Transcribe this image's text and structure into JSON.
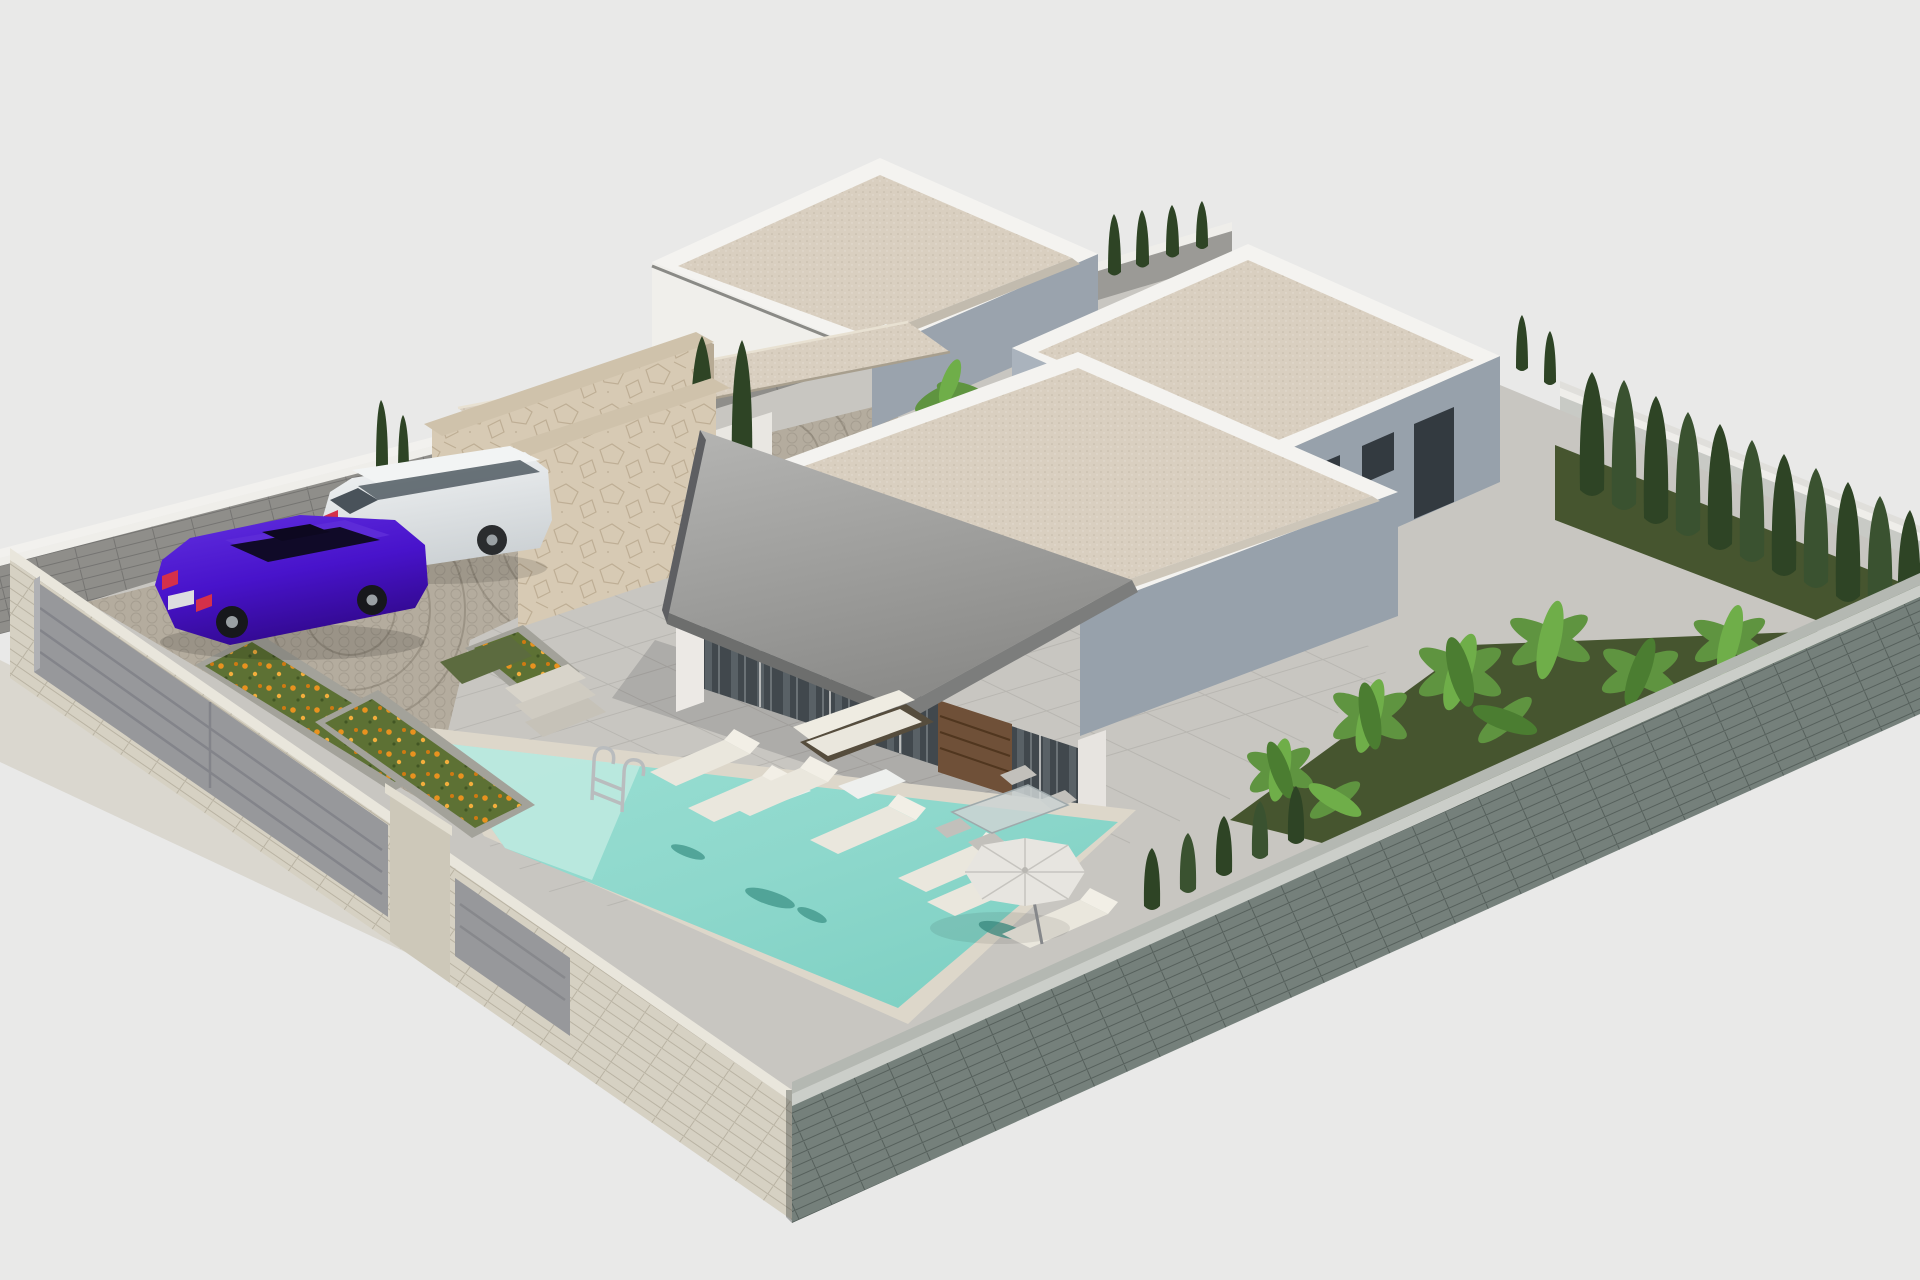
{
  "scene": {
    "title": "3D architectural rendering of a modern single-storey villa with pool",
    "style": "isometric exterior render on flat light-grey background",
    "background": "#e9e9e8",
    "colors": {
      "background": "#e9e9e8",
      "parapet_white": "#f4f3f0",
      "facade_white": "#f0efeb",
      "facade_shadow": "#97a1ab",
      "facade_shadow_light": "#aab3bd",
      "roof_gravel": "#d9cfc0",
      "awning_fascia": "#6d6e6d",
      "glass_dark": "#41484d",
      "wood_door": "#6f5038",
      "stone_clad": "#d7cab4",
      "stone_cap": "#cfc2ab",
      "wall_cap": "#efeeea",
      "wall_inner_nw": "#8f8e8a",
      "wall_inner_ne": "#c8cac5",
      "wall_outer_se": "#75807b",
      "wall_outer_sw": "#d6d1c3",
      "gate_grey": "#97989b",
      "pillar_beige": "#cdc8b9",
      "sidewalk": "#dad7cf",
      "terrace_paving": "#c8c6c1",
      "driveway_cobble": "#b4ac9e",
      "porch_shade": "rgba(35,38,42,0.16)",
      "pool_water": "#8ed8cc",
      "pool_shallow": "#bfeae1",
      "pool_coping": "#ddd7ca",
      "grass_dark": "#46552f",
      "grass_light": "#5c6b3f",
      "cypress_dark": "#2e4425",
      "banana_green": "#5f9440",
      "flower_green": "#5d7134",
      "flower_orange": "#e8921f",
      "car_purple": "#4813cb",
      "car_purple_roof": "#5d2bd8",
      "car_window_dark": "#100a28",
      "car_white": "#e9ecee",
      "suv_window": "#5c666d",
      "cushion_white": "#eae7dd",
      "wicker_dark": "#564d3d",
      "umbrella_white": "#e7e5e0",
      "chrome": "#b9bcbe",
      "taillight_red": "#d5304a"
    },
    "objects": [
      {
        "name": "main-villa",
        "desc": "white flat-roof villa with grey sloped awning, glass facade, wood slat door and covered terrace"
      },
      {
        "name": "back-house",
        "desc": "white flat-roof house at the rear with beige gravel roof"
      },
      {
        "name": "right-house",
        "desc": "white flat-roof house on the right with dark window openings on shaded facade"
      },
      {
        "name": "stone-privacy-walls",
        "desc": "beige natural-stone clad walls at the entrance courtyard"
      },
      {
        "name": "swimming-pool",
        "desc": "turquoise pool with chrome ladder and dark dolphin mosaic"
      },
      {
        "name": "sun-terrace",
        "desc": "grey paved terrace",
        "loungers": 7
      },
      {
        "name": "outdoor-lounge",
        "desc": "wicker sofa set with white cushions under the awning"
      },
      {
        "name": "dining-set",
        "desc": "glass table with grey chairs on the patio",
        "chairs": 5
      },
      {
        "name": "parasol",
        "desc": "white garden umbrella"
      },
      {
        "name": "purple-sedan",
        "desc": "vivid violet saloon car on cobbled driveway"
      },
      {
        "name": "white-suv",
        "desc": "white SUV parked along the rear wall"
      },
      {
        "name": "driveway",
        "desc": "cobbled parking court with circular fan pattern"
      },
      {
        "name": "flower-beds",
        "desc": "three planters with orange flowers",
        "count": 3
      },
      {
        "name": "cypress-hedge",
        "desc": "row of dark cypress trees along right boundary",
        "count": 11
      },
      {
        "name": "banana-garden",
        "desc": "bright banana plants on dark lawn beside right house"
      },
      {
        "name": "perimeter-walls",
        "desc": "grey block walls enclosing the plot"
      },
      {
        "name": "entrance-gates",
        "desc": "grey sliding vehicle gate, beige pillar and pedestrian gate"
      }
    ]
  }
}
